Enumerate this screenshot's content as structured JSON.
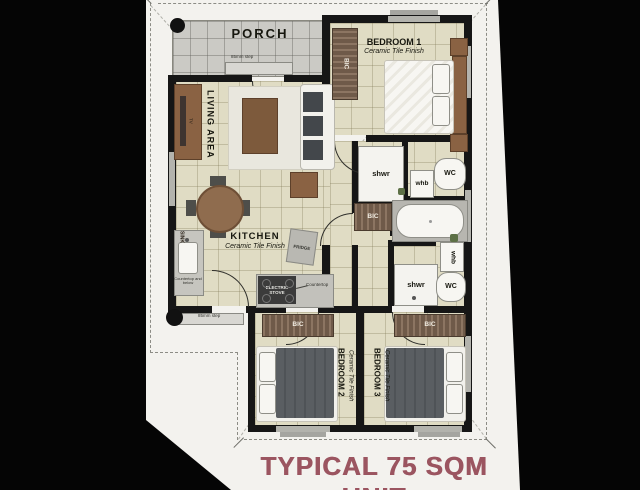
{
  "title": {
    "text": "TYPICAL 75 SQM UNIT"
  },
  "rooms": {
    "porch": {
      "name": "PORCH",
      "step_note": "85mm step"
    },
    "living": {
      "name": "LIVING AREA",
      "tv": "TV"
    },
    "kitchen": {
      "name": "KITCHEN",
      "finish": "Ceramic Tile Finish",
      "sink": "SINK",
      "fridge": "FRIDGE",
      "stove": "ELECTRIC STOVE",
      "countertop": "Countertop",
      "counter_note": "Countertop and below",
      "step_note": "85mm step"
    },
    "bedroom1": {
      "name": "BEDROOM 1",
      "finish": "Ceramic Tile Finish",
      "closet": "BIC"
    },
    "bedroom2": {
      "name": "BEDROOM 2",
      "finish": "Ceramic Tile Finish",
      "closet": "BIC"
    },
    "bedroom3": {
      "name": "BEDROOM 3",
      "finish": "Ceramic Tile Finish",
      "closet": "BIC"
    },
    "bath_main": {
      "shower": "shwr",
      "basin": "whb",
      "toilet": "WC",
      "closet": "BIC"
    },
    "bath_second": {
      "shower": "shwr",
      "basin": "whb",
      "toilet": "WC"
    }
  },
  "colors": {
    "background": "#050505",
    "sheet": "#f3f2ee",
    "floor_tile": "#e0dcc4",
    "porch_tile": "#cbcac5",
    "wall": "#161616",
    "wood": "#8a6243",
    "closet_stripe": "#6f5a49",
    "title": "#9b5560"
  }
}
